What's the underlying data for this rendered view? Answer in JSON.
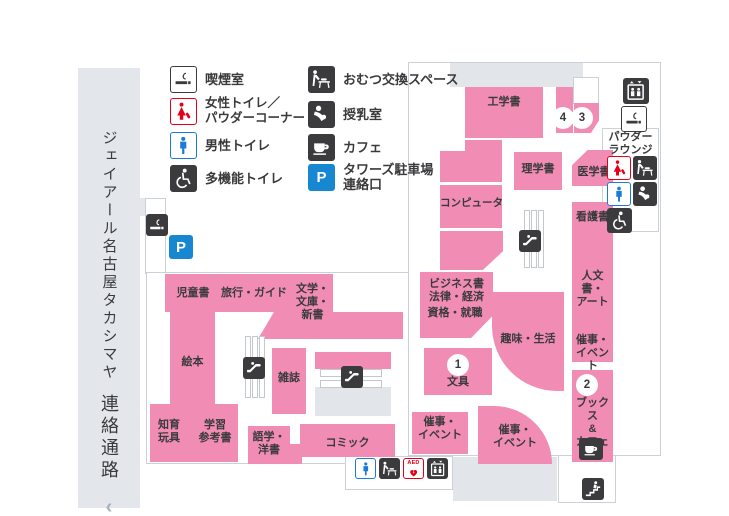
{
  "passage": {
    "building": "ジェイアール名古屋タカシマヤ",
    "label": "連絡通路",
    "chevron": "‹"
  },
  "legend": {
    "items": [
      {
        "icon": "smoking-room-icon",
        "label": "喫煙室"
      },
      {
        "icon": "women-toilet-icon",
        "label": "女性トイレ／\nパウダーコーナー"
      },
      {
        "icon": "men-toilet-icon",
        "label": "男性トイレ"
      },
      {
        "icon": "accessible-toilet-icon",
        "label": "多機能トイレ"
      },
      {
        "icon": "diaper-change-icon",
        "label": "おむつ交換スペース"
      },
      {
        "icon": "nursing-room-icon",
        "label": "授乳室"
      },
      {
        "icon": "cafe-icon",
        "label": "カフェ"
      },
      {
        "icon": "towers-parking-icon",
        "label": "タワーズ駐車場\n連絡口"
      }
    ]
  },
  "map": {
    "powder_lounge": "パウダー\nラウンジ",
    "sections": {
      "jidosho": "児童書",
      "ryoko": "旅行・ガイド",
      "bungaku": "文学・\n文庫・\n新書",
      "ehon": "絵本",
      "chiiku": "知育\n玩具",
      "gakushu": "学習\n参考書",
      "gogaku": "語学・\n洋書",
      "zasshi": "雑誌",
      "comic": "コミック",
      "kogaku": "工学書",
      "rigaku": "理学書",
      "igaku": "医学書",
      "computer": "コンピュータ",
      "kango": "看護書",
      "jinbun": "人文書・\nアート",
      "saiji_right": "催事・\nイベント",
      "business": "ビジネス書\n法律・経済",
      "shikaku": "資格・就職",
      "shumi": "趣味・生活",
      "bungu": "文具",
      "saiji_center": "催事・\nイベント",
      "saiji_small": "催事・\nイベント",
      "books_cafe": "ブックス\n&\nカフェ"
    },
    "markers": {
      "n1": "1",
      "n2": "2",
      "n3": "3",
      "n4": "4",
      "parking": "P",
      "aed": "AED"
    }
  },
  "colors": {
    "pink": "#F18DB5",
    "band_gray": "#E3E7EC",
    "block_gray": "#E2E5E9",
    "floor_line": "#CBD1D6",
    "icon_dark": "#3B3B3D",
    "toilet_blue": "#1C7CD5",
    "toilet_red": "#E50019",
    "parking_blue": "#1887D2",
    "text": "#3A3A3C"
  }
}
